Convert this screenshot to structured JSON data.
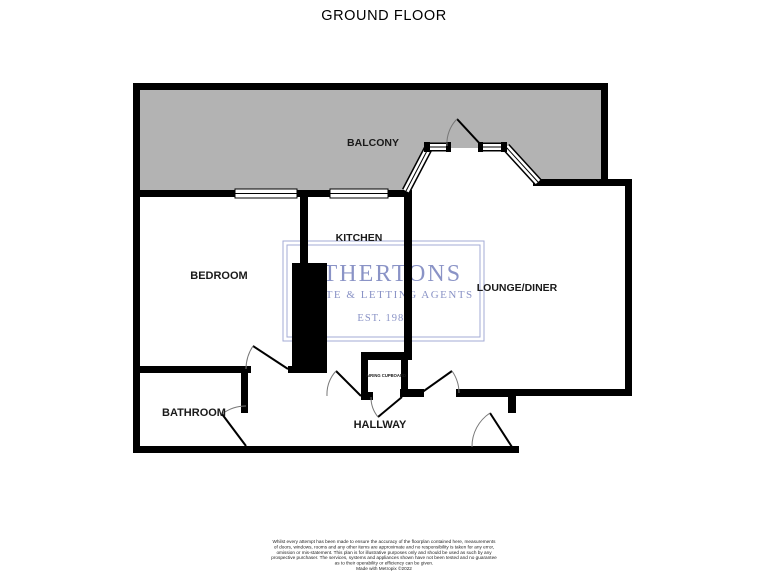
{
  "title": "GROUND FLOOR",
  "floorplan": {
    "rooms": {
      "balcony": "BALCONY",
      "bedroom": "BEDROOM",
      "kitchen": "KITCHEN",
      "lounge_diner": "LOUNGE/DINER",
      "bathroom": "BATHROOM",
      "hallway": "HALLWAY",
      "airing_cupboard": "AIRING CUPBOARD"
    },
    "colors": {
      "wall": "#000000",
      "balcony_fill": "#b3b3b3",
      "watermark_blue": "#8a93c6",
      "watermark_border": "#a3abd6",
      "background": "#ffffff"
    }
  },
  "watermark": {
    "agency_name": "ATHERTONS",
    "tagline": "ESTATE & LETTING AGENTS",
    "established": "EST. 1985"
  },
  "footer": {
    "disclaimer_lines": [
      "Whilst every attempt has been made to ensure the accuracy of the floorplan contained here, measurements",
      "of doors, windows, rooms and any other items are approximate and no responsibility is taken for any error,",
      "omission or mis-statement. This plan is for illustrative purposes only and should be used as such by any",
      "prospective purchaser. The services, systems and appliances shown have not been tested and no guarantee",
      "as to their operability or efficiency can be given."
    ],
    "credit": "Made with Metropix ©2022"
  }
}
